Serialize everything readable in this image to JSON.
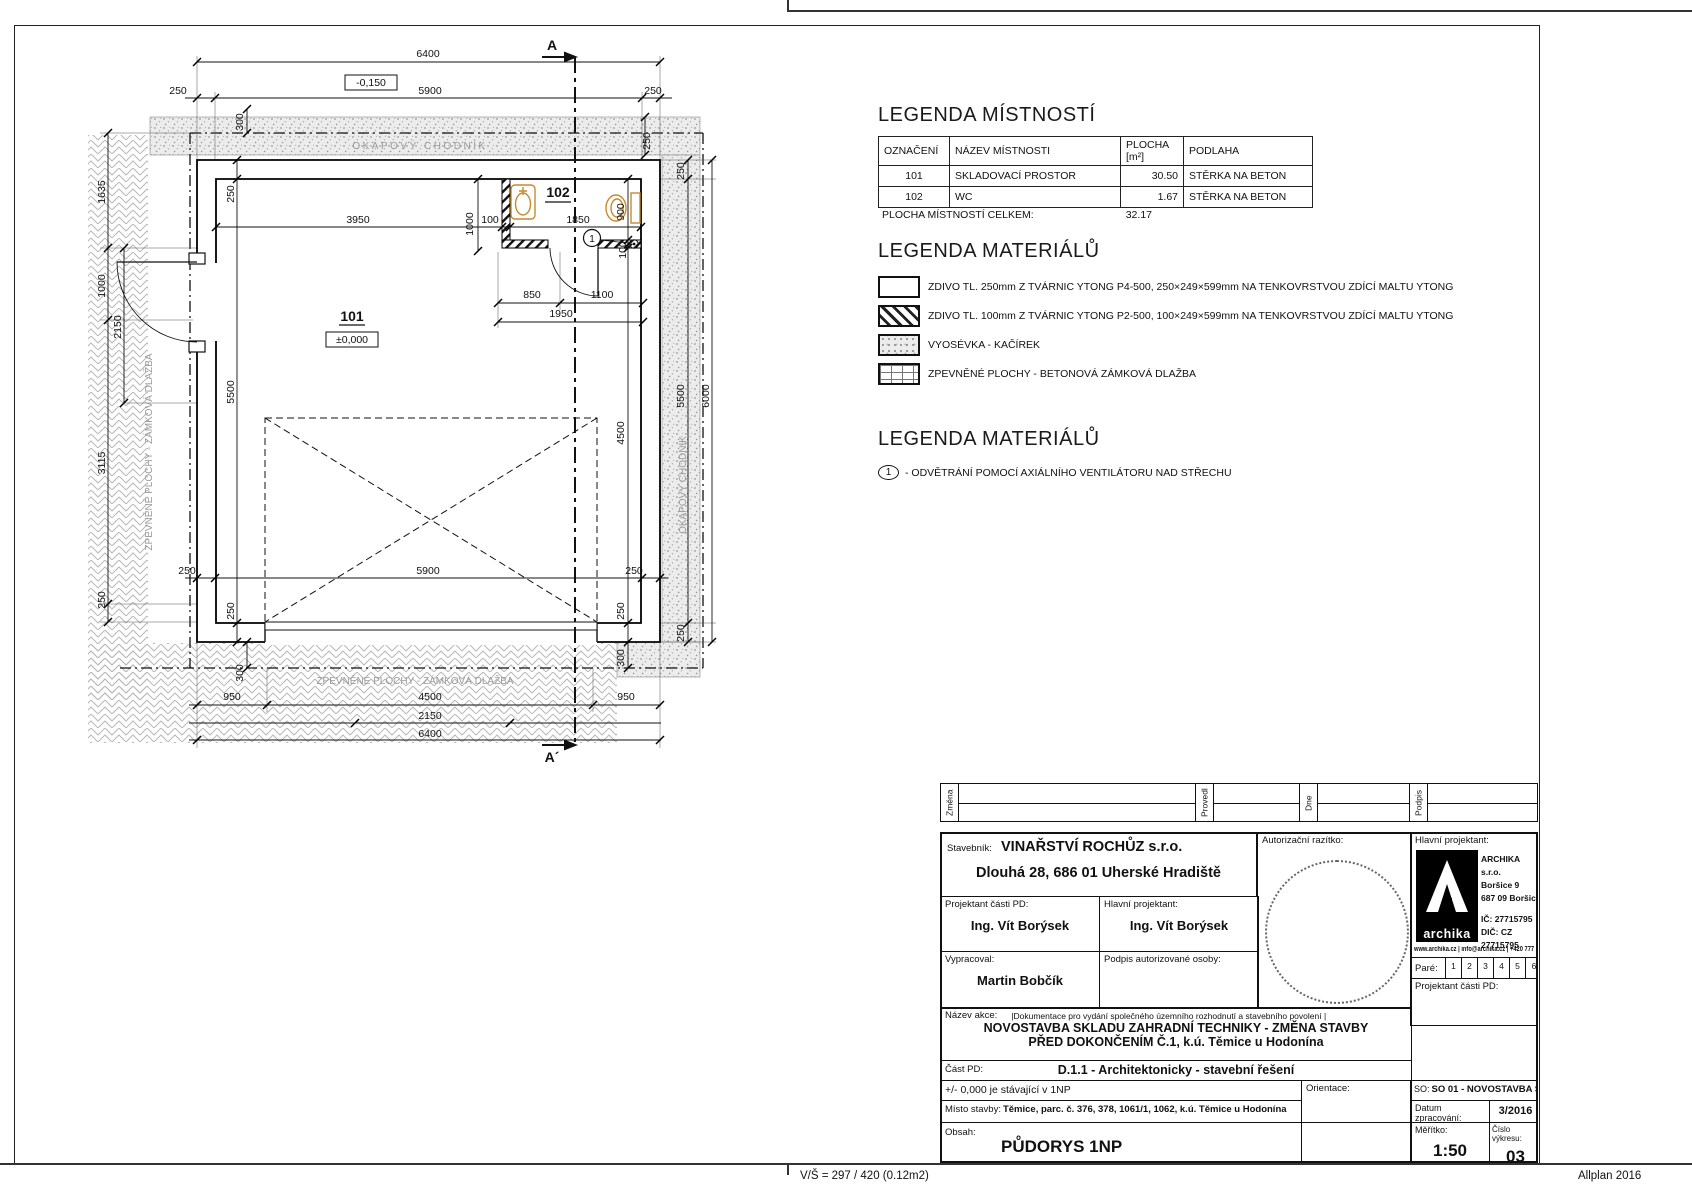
{
  "page": {
    "footer_left": "V/Š = 297 / 420 (0.12m2)",
    "footer_right": "Allplan 2016"
  },
  "colors": {
    "fixture_orange": "#c8882e",
    "pattern_grey": "#9a9a9a"
  },
  "legend_rooms": {
    "title": "LEGENDA MÍSTNOSTÍ",
    "headers": [
      "OZNAČENÍ",
      "NÁZEV MÍSTNOSTI",
      "PLOCHA [m²]",
      "PODLAHA"
    ],
    "rows": [
      [
        "101",
        "SKLADOVACÍ PROSTOR",
        "30.50",
        "STĚRKA NA BETON"
      ],
      [
        "102",
        "WC",
        "1.67",
        "STĚRKA NA BETON"
      ]
    ],
    "total_label": "PLOCHA MÍSTNOSTÍ CELKEM:",
    "total_value": "32.17"
  },
  "legend_materials": {
    "title": "LEGENDA MATERIÁLŮ",
    "items": [
      {
        "swatch": "solid",
        "label": "ZDIVO TL. 250mm Z TVÁRNIC YTONG P4-500, 250×249×599mm NA TENKOVRSTVOU ZDÍCÍ MALTU YTONG"
      },
      {
        "swatch": "hatch",
        "label": "ZDIVO TL. 100mm Z TVÁRNIC YTONG P2-500, 100×249×599mm NA TENKOVRSTVOU ZDÍCÍ MALTU YTONG"
      },
      {
        "swatch": "stipple",
        "label": "VYOSÉVKA - KAČÍREK"
      },
      {
        "swatch": "pavers",
        "label": "ZPEVNĚNÉ PLOCHY - BETONOVÁ ZÁMKOVÁ DLAŽBA"
      }
    ]
  },
  "legend_notes": {
    "title": "LEGENDA MATERIÁLŮ",
    "items": [
      {
        "symbol": "1",
        "label": "- ODVĚTRÁNÍ POMOCÍ AXIÁLNÍHO VENTILÁTORU NAD STŘECHU"
      }
    ]
  },
  "plan": {
    "labels": [
      {
        "t": "6400",
        "x": 428,
        "y": 57
      },
      {
        "t": "250",
        "x": 178,
        "y": 94
      },
      {
        "t": "5900",
        "x": 430,
        "y": 94
      },
      {
        "t": "250",
        "x": 653,
        "y": 94
      },
      {
        "t": "-0,150",
        "x": 371,
        "y": 86,
        "c": "bx"
      },
      {
        "t": "A",
        "x": 552,
        "y": 50,
        "c": "s"
      },
      {
        "t": "A´",
        "x": 552,
        "y": 762,
        "c": "s"
      },
      {
        "t": "300",
        "x": 243,
        "y": 122,
        "r": 1
      },
      {
        "t": "250",
        "x": 650,
        "y": 141,
        "r": 1
      },
      {
        "t": "OKAPOVÝ CHODNÍK",
        "x": 420,
        "y": 149,
        "c": "g1"
      },
      {
        "t": "OKAPOVÝ CHODNÍK",
        "x": 686,
        "y": 485,
        "r": 1,
        "c": "g"
      },
      {
        "t": "1635",
        "x": 105,
        "y": 192,
        "r": 1
      },
      {
        "t": "1000",
        "x": 105,
        "y": 286,
        "r": 1
      },
      {
        "t": "2150",
        "x": 121,
        "y": 327,
        "r": 1
      },
      {
        "t": "3115",
        "x": 105,
        "y": 463,
        "r": 1
      },
      {
        "t": "250",
        "x": 105,
        "y": 600,
        "r": 1
      },
      {
        "t": "ZPEVNĚNÉ PLOCHY - ZÁMKOVÁ DLAŽBA",
        "x": 152,
        "y": 452,
        "r": 1,
        "c": "g"
      },
      {
        "t": "250",
        "x": 234,
        "y": 194,
        "r": 1
      },
      {
        "t": "5500",
        "x": 234,
        "y": 392,
        "r": 1
      },
      {
        "t": "250",
        "x": 234,
        "y": 611,
        "r": 1
      },
      {
        "t": "3950",
        "x": 358,
        "y": 223
      },
      {
        "t": "1000",
        "x": 473,
        "y": 224,
        "r": 1
      },
      {
        "t": "100",
        "x": 490,
        "y": 223
      },
      {
        "t": "1850",
        "x": 578,
        "y": 223
      },
      {
        "t": "900",
        "x": 624,
        "y": 212,
        "r": 1
      },
      {
        "t": "100",
        "x": 626,
        "y": 250,
        "r": 1
      },
      {
        "t": "102",
        "x": 558,
        "y": 197,
        "c": "rm"
      },
      {
        "t": "101",
        "x": 352,
        "y": 321,
        "c": "rm"
      },
      {
        "t": "±0,000",
        "x": 352,
        "y": 343,
        "c": "bx"
      },
      {
        "t": "850",
        "x": 532,
        "y": 298
      },
      {
        "t": "1100",
        "x": 602,
        "y": 298
      },
      {
        "t": "1950",
        "x": 561,
        "y": 317
      },
      {
        "t": "4500",
        "x": 624,
        "y": 433,
        "r": 1
      },
      {
        "t": "250",
        "x": 624,
        "y": 611,
        "r": 1
      },
      {
        "t": "300",
        "x": 624,
        "y": 658,
        "r": 1
      },
      {
        "t": "250",
        "x": 684,
        "y": 171,
        "r": 1
      },
      {
        "t": "5500",
        "x": 684,
        "y": 396,
        "r": 1
      },
      {
        "t": "250",
        "x": 684,
        "y": 633,
        "r": 1
      },
      {
        "t": "6000",
        "x": 709,
        "y": 396,
        "r": 1
      },
      {
        "t": "250",
        "x": 187,
        "y": 574
      },
      {
        "t": "5900",
        "x": 428,
        "y": 574
      },
      {
        "t": "250",
        "x": 634,
        "y": 574
      },
      {
        "t": "300",
        "x": 243,
        "y": 673,
        "r": 1
      },
      {
        "t": "ZPEVNĚNÉ PLOCHY - ZÁMKOVÁ DLAŽBA",
        "x": 415,
        "y": 684,
        "c": "g"
      },
      {
        "t": "950",
        "x": 232,
        "y": 700
      },
      {
        "t": "4500",
        "x": 430,
        "y": 700
      },
      {
        "t": "950",
        "x": 626,
        "y": 700
      },
      {
        "t": "2150",
        "x": 430,
        "y": 719
      },
      {
        "t": "6400",
        "x": 430,
        "y": 737
      },
      {
        "t": "1",
        "x": 592,
        "y": 242,
        "c": "vn"
      }
    ]
  },
  "title_block": {
    "revision": {
      "zmena": "Změna",
      "provedl": "Provedl",
      "dne": "Dne",
      "podpis": "Podpis"
    },
    "stavebnik_label": "Stavebník:",
    "stavebnik_name": "VINAŘSTVÍ ROCHŮZ s.r.o.",
    "stavebnik_address": "Dlouhá 28, 686 01 Uherské Hradiště",
    "projektant_casti_label": "Projektant části PD:",
    "projektant_casti": "Ing. Vít Borýsek",
    "hlavni_projektant_label": "Hlavní projektant:",
    "hlavni_projektant": "Ing. Vít Borýsek",
    "vypracoval_label": "Vypracoval:",
    "vypracoval": "Martin Bobčík",
    "podpis_label": "Podpis autorizované osoby:",
    "razitko_label": "Autorizační razítko:",
    "nazev_akce_label": "Název akce:",
    "nazev_akce_note": "|Dokumentace pro vydání společného územního rozhodnutí a stavebního povolení |",
    "nazev_akce_line1": "NOVOSTAVBA SKLADU ZAHRADNÍ TECHNIKY - ZMĚNA STAVBY",
    "nazev_akce_line2": "PŘED DOKONČENÍM Č.1, k.ú. Těmice u Hodonína",
    "cast_pd_label": "Část PD:",
    "cast_pd": "D.1.1 - Architektonicky - stavební řešení",
    "note_000": "+/- 0,000 je stávající v 1NP",
    "orientace_label": "Orientace:",
    "misto_label": "Místo stavby:",
    "misto": "Těmice, parc. č. 376, 378, 1061/1, 1062, k.ú. Těmice u Hodonína",
    "obsah_label": "Obsah:",
    "obsah": "PŮDORYS 1NP",
    "archika": {
      "hlavni_label": "Hlavní projektant:",
      "logo_text": "archika",
      "name": "ARCHIKA s.r.o.",
      "addr1": "Boršice 9",
      "addr2": "687 09 Boršice",
      "ic": "IČ: 27715795",
      "dic": "DIČ: CZ 27715795",
      "web": "www.archika.cz | info@archika.cz | +420 777 691 916",
      "pare_label": "Paré:",
      "pare": [
        "1",
        "2",
        "3",
        "4",
        "5",
        "6"
      ],
      "proj_label": "Projektant části PD:",
      "so_label": "SO:",
      "so": "SO 01 - NOVOSTAVBA SKLADU",
      "datum_label": "Datum zpracování:",
      "datum": "3/2016",
      "meritko_label": "Měřítko:",
      "meritko": "1:50",
      "cislo_label": "Číslo výkresu:",
      "cislo": "03"
    }
  }
}
